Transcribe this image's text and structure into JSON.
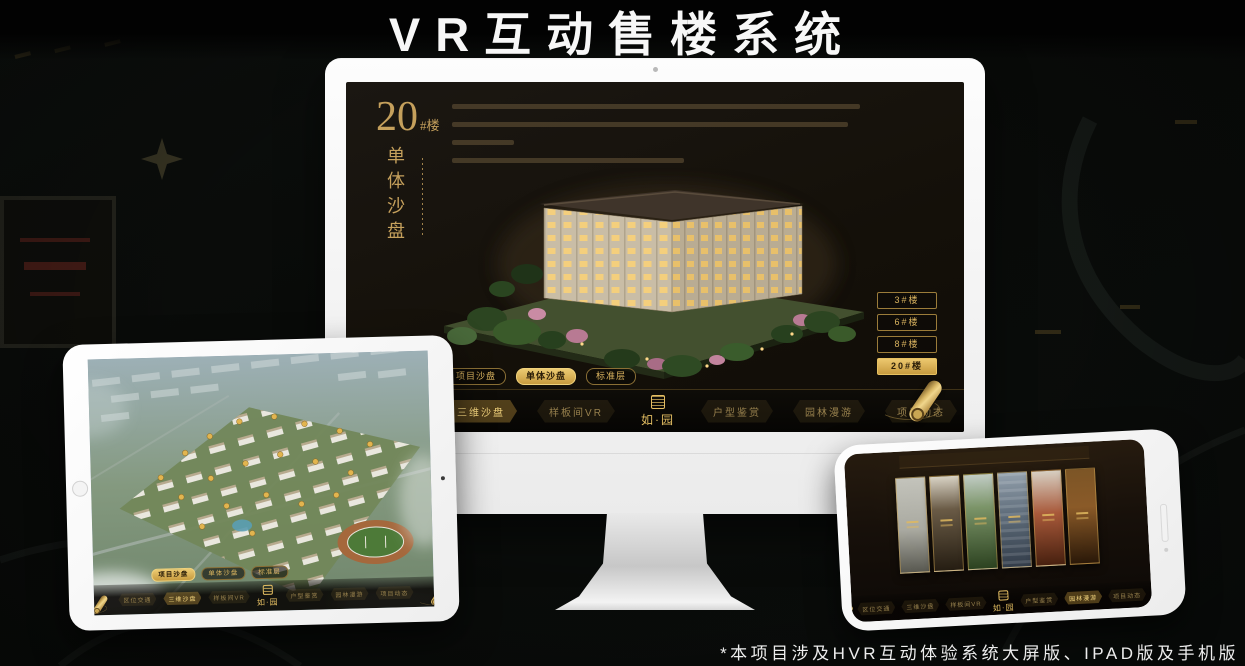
{
  "page": {
    "title": "VR互动售楼系统",
    "footnote": "*本项目涉及HVR互动体验系统大屏版、IPAD版及手机版"
  },
  "colors": {
    "accent_gold": "#d4a94f",
    "screen_background": "#171310",
    "device_white": "#fafafa"
  },
  "brand": {
    "logo_text": "如·园"
  },
  "nav_items": [
    "区位交通",
    "三维沙盘",
    "样板间VR",
    "户型鉴赏",
    "园林漫游",
    "项目动态"
  ],
  "sub_tabs": [
    "项目沙盘",
    "单体沙盘",
    "标准层"
  ],
  "monitor_app": {
    "headline_number": "20",
    "headline_suffix": "#楼",
    "headline_vertical": "单体沙盘",
    "floor_buttons": [
      "3#楼",
      "6#楼",
      "8#楼",
      "20#楼"
    ],
    "active_floor": "20#楼",
    "active_sub_tab": "单体沙盘",
    "active_nav": "三维沙盘"
  },
  "tablet_app": {
    "active_sub_tab": "项目沙盘",
    "active_nav": "三维沙盘"
  },
  "phone_app": {
    "active_nav": "园林漫游"
  }
}
